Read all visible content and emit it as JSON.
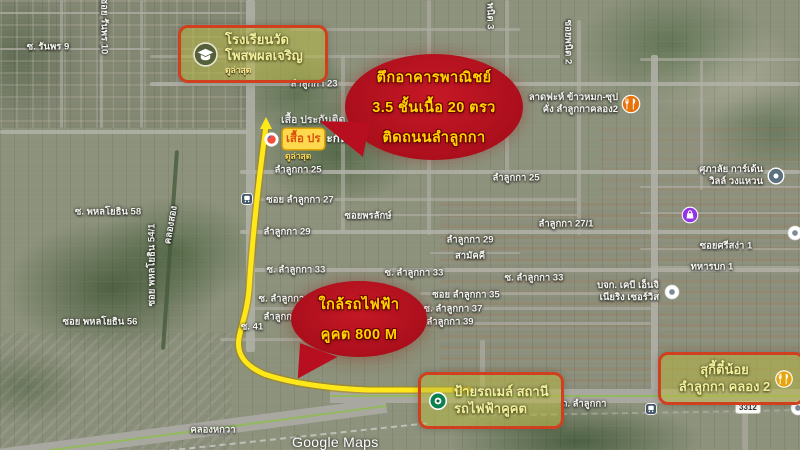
{
  "watermark": "Google Maps",
  "route_badge": "3312",
  "colors": {
    "route_yellow": "#ffe81a",
    "bubble_red": "#b80f20",
    "bubble_text_yellow": "#ffd400",
    "highlight_border": "#d0401f",
    "highlight_fill": "#b8b84285",
    "highlight_text": "#f2ef9e"
  },
  "bubbles": [
    {
      "id": "bubble-commercial-building",
      "x": 345,
      "y": 54,
      "w": 178,
      "h": 106,
      "tail": "left",
      "lines": [
        "ตึกอาคารพาณิชย์",
        "3.5 ชั้นเนื้อ 20 ตรว",
        "ติดถนนลำลูกกา"
      ]
    },
    {
      "id": "bubble-near-bts",
      "x": 291,
      "y": 281,
      "w": 136,
      "h": 76,
      "tail": "down",
      "lines": [
        "ใกล้รถไฟฟ้า",
        "คูคต 800 M"
      ]
    }
  ],
  "places": [
    {
      "id": "school",
      "x": 178,
      "y": 25,
      "w": 132,
      "h": 52,
      "icon": "school",
      "lines": [
        "โรงเรียนวัด",
        "โพสพผลเจริญ"
      ],
      "sub": "ดูล่าสุด"
    },
    {
      "id": "bts-station",
      "x": 418,
      "y": 372,
      "w": 132,
      "h": 51,
      "icon": "station",
      "lines": [
        "ป้ายรถเมล์ สถานี",
        "รถไฟฟ้าคูคต"
      ],
      "sub": ""
    },
    {
      "id": "suki-teenoi",
      "x": 658,
      "y": 352,
      "w": 141,
      "h": 47,
      "icon": "restaurant",
      "lines": [
        "สุกี้ตี๋น้อย",
        "ลำลูกกา คลอง 2"
      ],
      "sub": ""
    }
  ],
  "shop": {
    "white_line": "เสื้อ ประกันติด",
    "box_text": "เสื้อ ปร",
    "after_text": "ะกันติด โล่",
    "sub": "ดูล่าสุด"
  },
  "pois": [
    {
      "icon": "restaurant-orange",
      "x": 631,
      "y": 104,
      "lines": [
        "ลาดฟะห์ ข้าวหมก-ซุป",
        "คั่ง ลำลูกกาคลอง2"
      ]
    },
    {
      "icon": "place-gray",
      "x": 776,
      "y": 176,
      "lines": [
        "ศุภาลัย การ์เด้น",
        "วิลล์ วงแหวน"
      ]
    },
    {
      "icon": "shopping-purple",
      "x": 690,
      "y": 215,
      "lines": []
    },
    {
      "icon": "place-white",
      "x": 672,
      "y": 292,
      "lines": [
        "บจก. เคบี เอ็นจิ",
        "เนียริง เซอร์วิส"
      ]
    },
    {
      "icon": "place-white",
      "x": 795,
      "y": 233,
      "lines": []
    },
    {
      "icon": "transit",
      "x": 247,
      "y": 199,
      "lines": []
    },
    {
      "icon": "transit",
      "x": 651,
      "y": 409,
      "lines": []
    },
    {
      "icon": "place-white",
      "x": 798,
      "y": 408,
      "lines": []
    }
  ],
  "street_labels": [
    {
      "t": "ซ. รันพร 9",
      "x": 48,
      "y": 47
    },
    {
      "t": "ซอย รันพร 10",
      "x": 104,
      "y": 26,
      "r": 90
    },
    {
      "t": "พนิต 3",
      "x": 490,
      "y": 16,
      "r": 90
    },
    {
      "t": "ซอยพนิต 2",
      "x": 568,
      "y": 42,
      "r": 90
    },
    {
      "t": "ซ. พหลโยธิน 58",
      "x": 108,
      "y": 212
    },
    {
      "t": "ซอย พหลโยธิน 54/1",
      "x": 152,
      "y": 265,
      "r": -90
    },
    {
      "t": "ซอย พหลโยธิน 56",
      "x": 100,
      "y": 322
    },
    {
      "t": "คลองสอง",
      "x": 171,
      "y": 225,
      "r": -80
    },
    {
      "t": "คลองหกวา",
      "x": 213,
      "y": 430
    },
    {
      "t": "ลำลูกกา 23",
      "x": 314,
      "y": 84
    },
    {
      "t": "ลำลูกกา 25",
      "x": 298,
      "y": 170
    },
    {
      "t": "ลำลูกกา 25",
      "x": 516,
      "y": 178
    },
    {
      "t": "ซอย ลำลูกกา 27",
      "x": 300,
      "y": 200
    },
    {
      "t": "ลำลูกกา 27/1",
      "x": 566,
      "y": 224
    },
    {
      "t": "ซอยพรลักษ์",
      "x": 368,
      "y": 216
    },
    {
      "t": "ลำลูกกา 29",
      "x": 287,
      "y": 232
    },
    {
      "t": "ลำลูกกา 29",
      "x": 470,
      "y": 240
    },
    {
      "t": "สามัคคี",
      "x": 470,
      "y": 256
    },
    {
      "t": "ซ. ลำลูกกา 33",
      "x": 296,
      "y": 270
    },
    {
      "t": "ซ. ลำลูกกา 33",
      "x": 414,
      "y": 273
    },
    {
      "t": "ซ. ลำลูกกา 33",
      "x": 534,
      "y": 278
    },
    {
      "t": "ซ. ลำลูกกา 35",
      "x": 288,
      "y": 299
    },
    {
      "t": "ซอย ลำลูกกา 35",
      "x": 466,
      "y": 295
    },
    {
      "t": "ลำลูกกา 35",
      "x": 287,
      "y": 317
    },
    {
      "t": "ซ. ลำลูกกา 37",
      "x": 453,
      "y": 309
    },
    {
      "t": "ลำลูกกา 39",
      "x": 450,
      "y": 322
    },
    {
      "t": "ซ. 41",
      "x": 252,
      "y": 327
    },
    {
      "t": "ซอยศรีสง่า 1",
      "x": 726,
      "y": 246
    },
    {
      "t": "ทหารบก 1",
      "x": 712,
      "y": 267
    },
    {
      "t": "ถ. ลำลูกกา",
      "x": 584,
      "y": 404
    }
  ]
}
